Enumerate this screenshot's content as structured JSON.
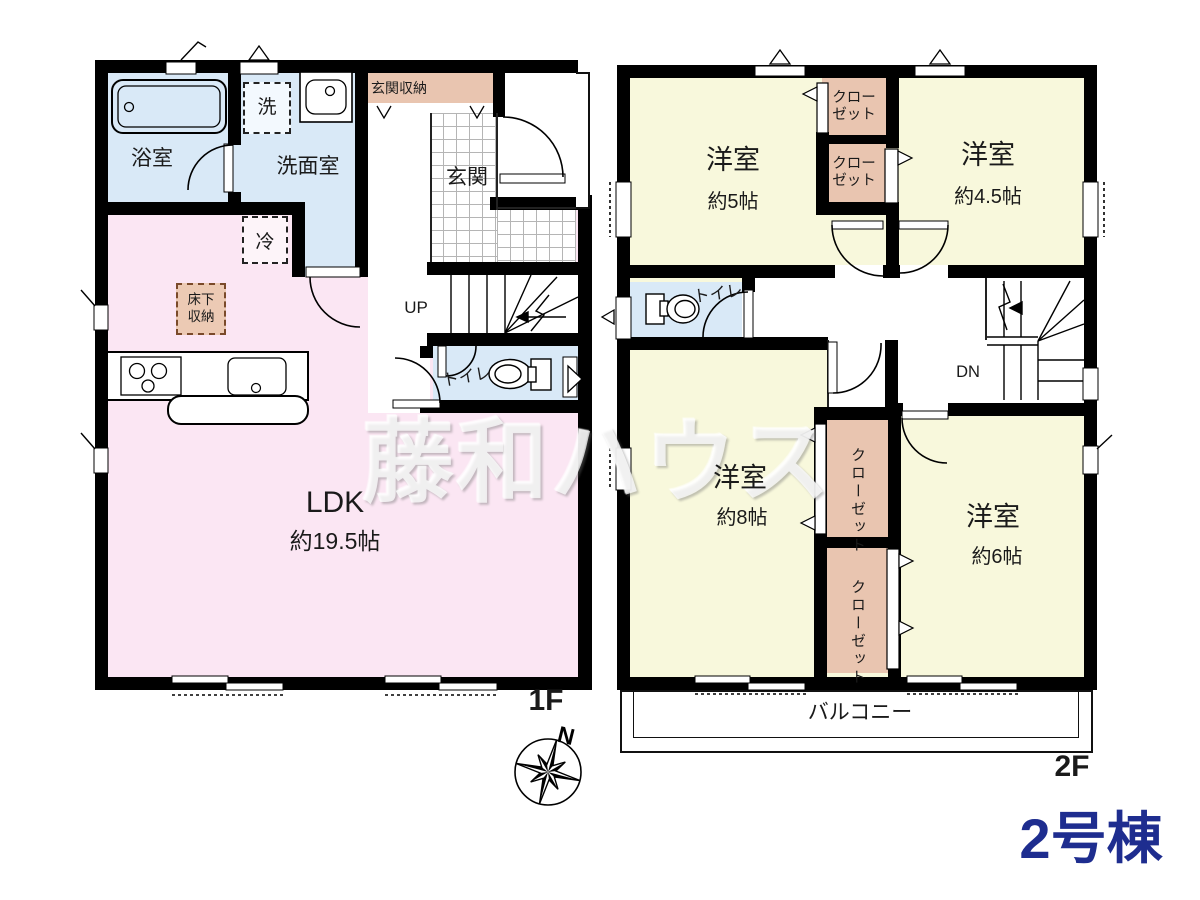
{
  "building": {
    "title": "2号棟"
  },
  "watermark": "藤和ハウス",
  "compass": {
    "north": "N"
  },
  "colors": {
    "accent_navy": "#1e2d8f",
    "room_pink": "#fbe6f3",
    "room_blue": "#d9e9f7",
    "room_yellow": "#f8f8dc",
    "closet_tan": "#e9c5b0"
  },
  "floor1": {
    "label": "1F",
    "bath": "浴室",
    "washroom": "洗面室",
    "washer": "洗",
    "fridge": "冷",
    "entrance_storage": "玄関収納",
    "entrance": "玄関",
    "underfloor": "床下収納",
    "ldk_name": "LDK",
    "ldk_size": "約19.5帖",
    "toilet": "トイレ",
    "stairs_label": "UP"
  },
  "floor2": {
    "label": "2F",
    "rooms": [
      {
        "name": "洋室",
        "size": "約5帖"
      },
      {
        "name": "洋室",
        "size": "約4.5帖"
      },
      {
        "name": "洋室",
        "size": "約8帖"
      },
      {
        "name": "洋室",
        "size": "約6帖"
      }
    ],
    "closet": "クローゼット",
    "closet_l1": "クロー",
    "closet_l2": "ゼット",
    "toilet": "トイレ",
    "stairs_label": "DN",
    "balcony": "バルコニー"
  }
}
